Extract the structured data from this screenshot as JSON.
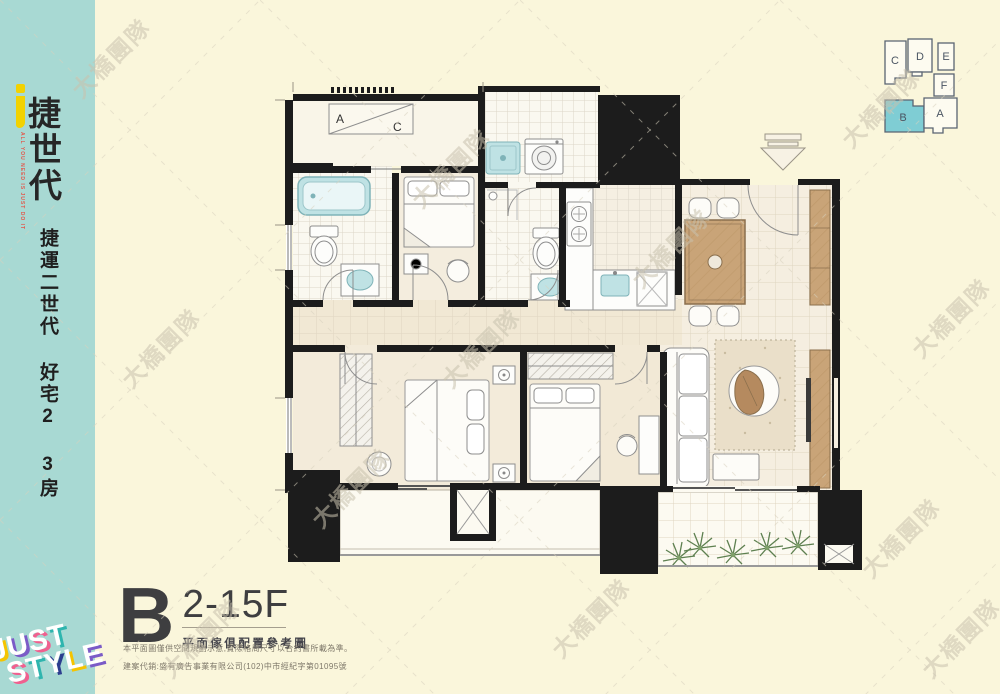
{
  "page": {
    "background": "#FAF6DB",
    "watermark_text": "大橋團隊"
  },
  "sidebar": {
    "background": "#A8D9D3",
    "brand": {
      "accent_glyph": "j",
      "accent_color": "#F2D200",
      "char_1": "捷",
      "char_2": "世",
      "char_3": "代",
      "tagline": "ALL YOU NEED IS JUST DO IT",
      "tagline_color": "#E2574B"
    },
    "slogan_vertical": "捷運二世代 好宅2 3房",
    "bottom_logo": {
      "line_1": "JUST",
      "line_2": "STYLE",
      "letter_color": "#FFFFFF",
      "shadow_colors": [
        "#F5C400",
        "#7B5BC7",
        "#F0608F",
        "#2FB5AE",
        "#2D3E8F"
      ]
    }
  },
  "key_plan": {
    "highlight_color": "#7FCDD4",
    "outline_color": "#5A6472",
    "units": [
      {
        "label": "C",
        "highlighted": false
      },
      {
        "label": "D",
        "highlighted": false
      },
      {
        "label": "E",
        "highlighted": false
      },
      {
        "label": "F",
        "highlighted": false
      },
      {
        "label": "B",
        "highlighted": true
      },
      {
        "label": "A",
        "highlighted": false
      }
    ]
  },
  "floor_plan": {
    "ac_box": {
      "label_left": "A",
      "label_right": "C"
    },
    "wall_color": "#1C1C1C",
    "fixture_accent_color": "#BFE2E4",
    "wood_color": "#C9A478",
    "fixtures": [
      "bathtub",
      "toilet",
      "vanity-sink",
      "bed",
      "wardrobe",
      "washing-machine",
      "shower-tray",
      "kitchen-stove",
      "kitchen-sink",
      "refrigerator",
      "dining-table",
      "dining-chairs",
      "sofa",
      "coffee-table",
      "area-rug",
      "tv-cabinet",
      "shoe-cabinet",
      "desk",
      "balcony-plants",
      "entrance-arrow"
    ]
  },
  "title_block": {
    "unit_letter": "B",
    "floor_range": "2-15F",
    "caption": "平面傢俱配置參考圖",
    "disclaimer_1": "本平面圖僅供空間規劃示意,實際格局尺寸以合約書所載為準。",
    "disclaimer_2": "建案代銷:盛有廣告事業有限公司(102)中市經紀字第01095號"
  }
}
